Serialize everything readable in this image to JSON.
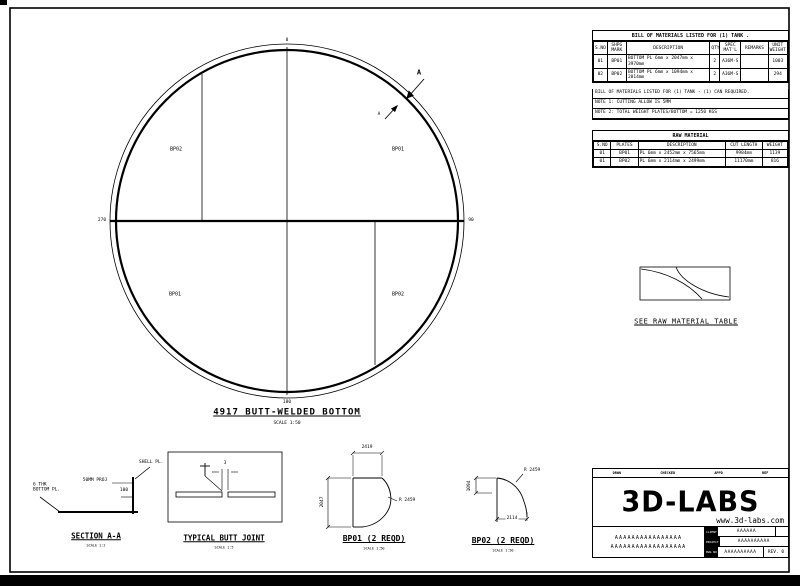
{
  "plan": {
    "title": "4917 BUTT-WELDED BOTTOM",
    "scale": "SCALE 1:50",
    "compass": {
      "top": "0",
      "right": "90",
      "bottom": "180",
      "left": "270"
    },
    "plate_labels": {
      "top_left": "BP02",
      "top_right": "BP01",
      "bottom_left": "BP01",
      "bottom_right": "BP02"
    },
    "section_letter": "A"
  },
  "bom": {
    "title": "BILL OF MATERIALS LISTED FOR (1) TANK .",
    "headers": [
      "S.NO",
      "SHPG\nMARK",
      "DESCRIPTION",
      "QTY",
      "SPEC\nMAT'L",
      "REMARKS",
      "UNIT\nWEIGHT"
    ],
    "rows": [
      [
        "01",
        "BP01",
        "BOTTOM PL 6mm x 2047mm x 3970mm",
        "2",
        "A36M-S",
        "",
        "1003"
      ],
      [
        "02",
        "BP02",
        "BOTTOM PL 6mm x 1094mm x 2014mm",
        "2",
        "A36M-S",
        "",
        "294"
      ]
    ],
    "notes": [
      "BILL OF MATERIALS LISTED FOR (1) TANK - (1) CAN REQUIRED.",
      "NOTE 1: CUTTING ALLOW IS 5MM",
      "NOTE 2: TOTAL WEIGHT PLATES/BOTTOM = 1250 KGS"
    ]
  },
  "raw_material": {
    "title": "RAW MATERIAL",
    "caption": "SEE RAW MATERIAL TABLE",
    "headers": [
      "S.NO",
      "PLATES",
      "DESCRIPTION",
      "CUT LENGTH",
      "WEIGHT"
    ],
    "rows": [
      [
        "01",
        "BP01",
        "PL 6mm x 2452mm x 7565mm",
        "9984mm",
        "1139"
      ],
      [
        "01",
        "BP02",
        "PL 6mm x 2114mm x 2499mm",
        "11170mm",
        "816"
      ]
    ]
  },
  "details": {
    "section_aa": {
      "title": "SECTION A-A",
      "scale": "SCALE 1:2",
      "shell_label": "SHELL PL.",
      "proj_label": "50MM PROJ",
      "dim_100": "100",
      "bottom_label": "6 THK\nBOTTOM PL."
    },
    "butt_joint": {
      "title": "TYPICAL BUTT JOINT",
      "scale": "SCALE 1:5",
      "gap_dim": "3"
    },
    "bp01": {
      "title": "BP01 (2 REQD)",
      "scale": "SCALE 1:50",
      "width_dim": "2419",
      "height_dim": "2047",
      "radius_dim": "R 2459"
    },
    "bp02": {
      "title": "BP02 (2 REQD)",
      "scale": "SCALE 1:50",
      "width_dim": "2114",
      "height_dim": "1094",
      "radius_dim": "R 2459"
    }
  },
  "title_block": {
    "logo": "3D-LABS",
    "website": "www.3d-labs.com",
    "approval_labels": [
      "DRWN",
      "CHECKED",
      "APPD",
      "REF"
    ],
    "description_lines": [
      "AAAAAAAAAAAAAAAA",
      "AAAAAAAAAAAAAAAAAA"
    ],
    "fields": [
      {
        "label": "CLIENT",
        "value": "AAAAAA"
      },
      {
        "label": "PROJECT",
        "value": "AAAAAAAAAA"
      },
      {
        "label": "DWG NO",
        "value": "AAAAAAAAAA"
      }
    ],
    "rev": "REV. 0"
  }
}
